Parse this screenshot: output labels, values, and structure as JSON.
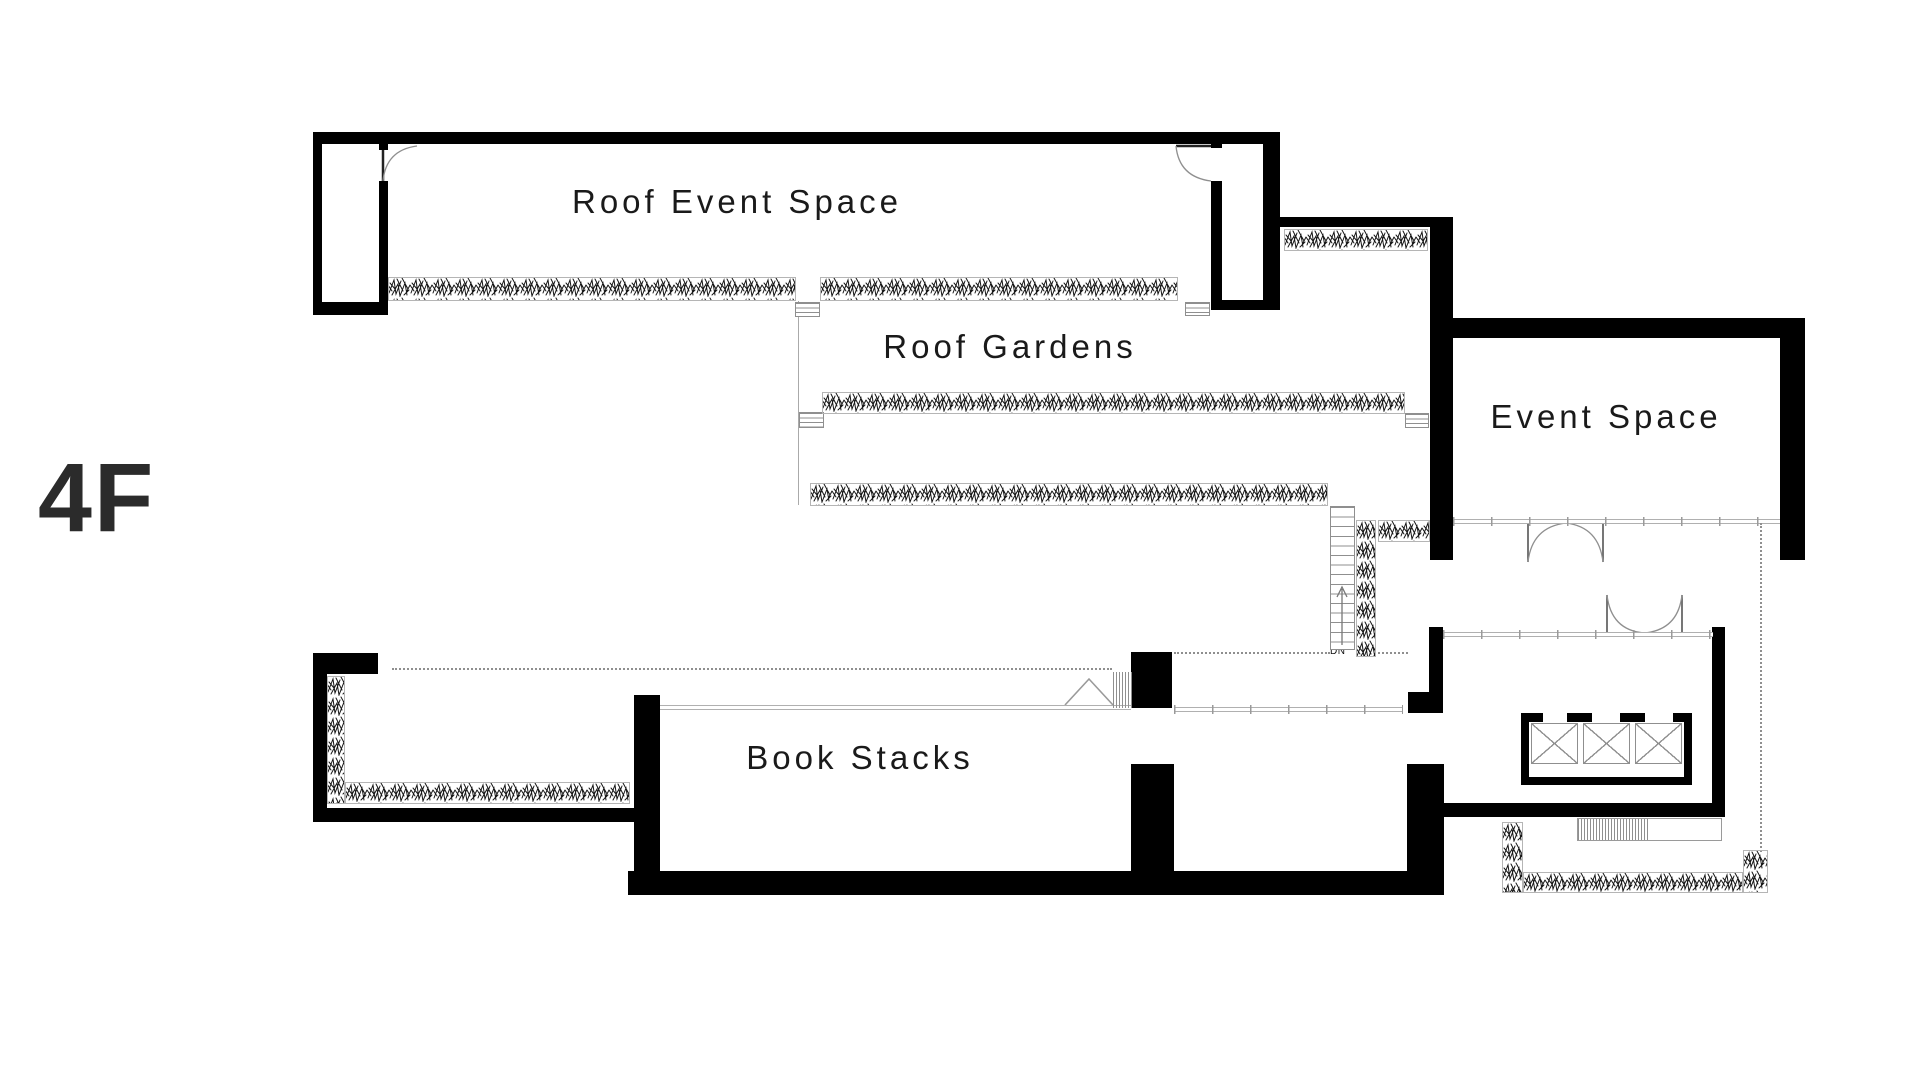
{
  "floor_label": "4F",
  "rooms": [
    {
      "name": "roof-event-space",
      "label": "Roof Event Space"
    },
    {
      "name": "roof-gardens",
      "label": "Roof Gardens"
    },
    {
      "name": "event-space",
      "label": "Event Space"
    },
    {
      "name": "book-stacks",
      "label": "Book Stacks"
    }
  ],
  "stairs": {
    "direction_label": "DN"
  },
  "colors": {
    "wall": "#000000",
    "thin_line": "#b0b0b0",
    "dotted_line": "#8f8f8f",
    "text": "#1a1a1a",
    "foliage": "#161616",
    "background": "#ffffff"
  }
}
